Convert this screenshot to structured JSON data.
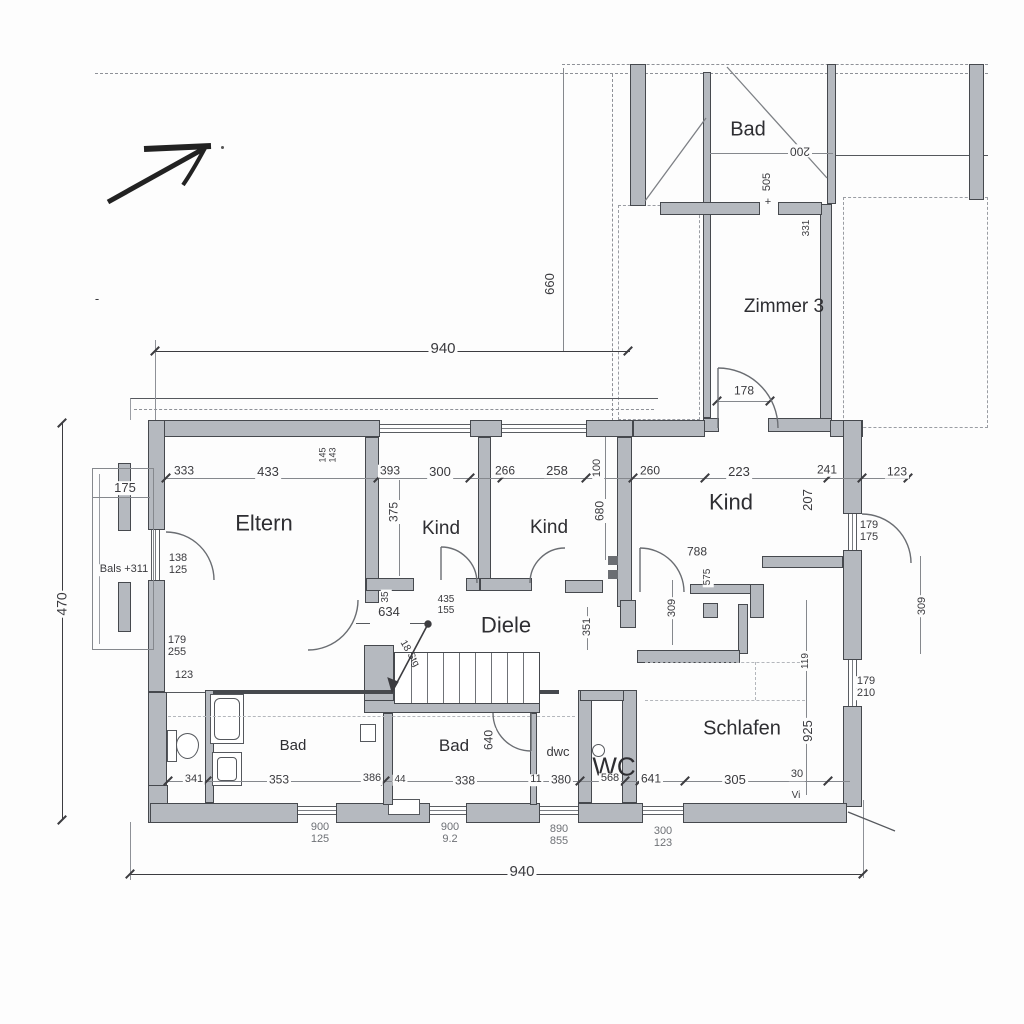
{
  "title": "Grundriss / floor plan (German)",
  "colors": {
    "wall_fill": "#b5b9bf",
    "wall_edge": "#46494e",
    "dim_text": "#3a3a3e",
    "line": "#55585d"
  },
  "rooms": {
    "eltern": "Eltern",
    "kind_left": "Kind",
    "kind_mid": "Kind",
    "kind_right": "Kind",
    "diele": "Diele",
    "bad_upper": "Bad",
    "zimmer3": "Zimmer 3",
    "bad_left": "Bad",
    "bad_mid": "Bad",
    "wc": "WC",
    "schlafen": "Schlafen",
    "balcony": "Bals +311"
  },
  "dims": {
    "overall_top": "940",
    "overall_bottom": "940",
    "overall_left": "470",
    "seg_333": "333",
    "seg_433": "433",
    "seg_393": "393",
    "seg_300": "300",
    "seg_266": "266",
    "seg_258": "258",
    "seg_260": "260",
    "seg_223": "223",
    "seg_241": "241",
    "seg_123": "123",
    "w175": "175",
    "d138": "138",
    "d125": "125",
    "d179a": "179",
    "d255": "255",
    "d179b": "179",
    "d175b": "175",
    "d179c": "179",
    "d210": "210",
    "left123": "123",
    "v375": "375",
    "v660": "660",
    "v100": "100",
    "v680": "680",
    "v351": "351",
    "v309a": "309",
    "v309b": "309",
    "v207": "207",
    "v575": "575",
    "v925": "925",
    "v119": "119",
    "v640": "640",
    "v331": "331",
    "v505": "505",
    "v35": "35",
    "n145": "145",
    "n143": "143",
    "n788": "788",
    "n634": "634",
    "n435": "435",
    "n155": "155",
    "door178": "178",
    "bad200": "200",
    "b341": "341",
    "b353": "353",
    "b386": "386",
    "b44": "44",
    "b338": "338",
    "b11": "11",
    "b380": "380",
    "b568": "568",
    "b641": "641",
    "b305": "305",
    "b30": "30"
  },
  "windows": [
    {
      "w": "900",
      "h": "125"
    },
    {
      "w": "900",
      "h": "9.2"
    },
    {
      "w": "890",
      "h": "855"
    },
    {
      "w": "300",
      "h": "123"
    }
  ],
  "annotations": {
    "stairs": "18 Stg",
    "dwc": "dwc",
    "vi": "Vi",
    "plus": "+",
    "dash": "-"
  }
}
